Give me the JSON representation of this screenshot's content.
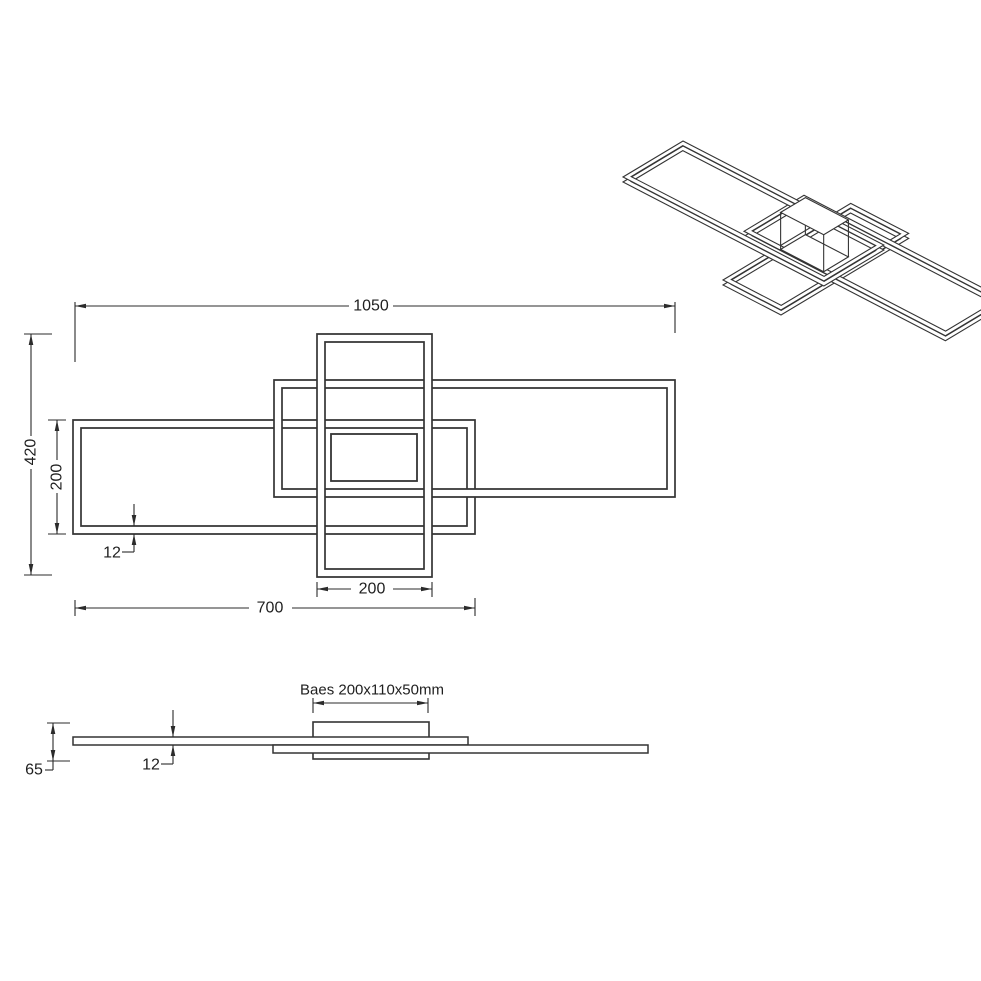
{
  "drawing_title": "ceiling-lamp-technical-drawing",
  "colors": {
    "background": "#ffffff",
    "frame_stroke": "#343434",
    "dim_stroke": "#2b2b2b",
    "text": "#1f1f1f"
  },
  "plan_view": {
    "frames": [
      {
        "name": "left-frame",
        "outer": [
          73,
          420,
          475,
          534
        ],
        "inner": [
          81,
          428,
          467,
          526
        ]
      },
      {
        "name": "right-frame",
        "outer": [
          274,
          380,
          675,
          497
        ],
        "inner": [
          282,
          388,
          667,
          489
        ]
      },
      {
        "name": "cross-frame",
        "outer": [
          317,
          334,
          432,
          577
        ],
        "inner": [
          325,
          342,
          424,
          569
        ]
      }
    ],
    "base_rect": [
      331,
      434,
      417,
      481
    ],
    "dimensions": [
      {
        "name": "dim-width-1050",
        "text": "1050",
        "lines": [
          [
            75,
            306,
            349,
            306
          ],
          [
            393,
            306,
            675,
            306
          ],
          [
            75,
            302,
            75,
            362
          ],
          [
            675,
            302,
            675,
            333
          ]
        ],
        "arrows": [
          [
            75,
            306,
            180
          ],
          [
            675,
            306,
            0
          ]
        ],
        "label": {
          "x": 371,
          "y": 306,
          "rot": 0
        }
      },
      {
        "name": "dim-height-420",
        "text": "420",
        "lines": [
          [
            31,
            334,
            31,
            436
          ],
          [
            31,
            469,
            31,
            575
          ],
          [
            24,
            334,
            52,
            334
          ],
          [
            24,
            575,
            52,
            575
          ]
        ],
        "arrows": [
          [
            31,
            334,
            -90
          ],
          [
            31,
            575,
            90
          ]
        ],
        "label": {
          "x": 31,
          "y": 452,
          "rot": -90
        }
      },
      {
        "name": "dim-height-200",
        "text": "200",
        "lines": [
          [
            57,
            420,
            57,
            460
          ],
          [
            57,
            493,
            57,
            534
          ],
          [
            48,
            420,
            66,
            420
          ],
          [
            48,
            534,
            66,
            534
          ]
        ],
        "arrows": [
          [
            57,
            420,
            -90
          ],
          [
            57,
            534,
            90
          ]
        ],
        "label": {
          "x": 57,
          "y": 477,
          "rot": -90
        }
      },
      {
        "name": "dim-thickness-12",
        "text": "12",
        "lines": [
          [
            134,
            504,
            134,
            526
          ],
          [
            134,
            534,
            134,
            552
          ],
          [
            122,
            552,
            134,
            552
          ]
        ],
        "arrows": [
          [
            134,
            526,
            90
          ],
          [
            134,
            534,
            -90
          ]
        ],
        "label": {
          "x": 112,
          "y": 553,
          "rot": 0
        }
      },
      {
        "name": "dim-width-200",
        "text": "200",
        "lines": [
          [
            317,
            582,
            317,
            597
          ],
          [
            432,
            582,
            432,
            597
          ],
          [
            317,
            589,
            351,
            589
          ],
          [
            393,
            589,
            432,
            589
          ]
        ],
        "arrows": [
          [
            317,
            589,
            180
          ],
          [
            432,
            589,
            0
          ]
        ],
        "label": {
          "x": 372,
          "y": 589,
          "rot": 0
        }
      },
      {
        "name": "dim-width-700",
        "text": "700",
        "lines": [
          [
            75,
            600,
            75,
            616
          ],
          [
            475,
            598,
            475,
            616
          ],
          [
            75,
            608,
            249,
            608
          ],
          [
            292,
            608,
            475,
            608
          ]
        ],
        "arrows": [
          [
            75,
            608,
            180
          ],
          [
            475,
            608,
            0
          ]
        ],
        "label": {
          "x": 270,
          "y": 608,
          "rot": 0
        }
      }
    ]
  },
  "side_view": {
    "base_box": [
      313,
      722,
      429,
      759
    ],
    "top_bar": [
      73,
      737,
      468,
      745
    ],
    "bottom_bar": [
      273,
      745,
      648,
      753
    ],
    "dimensions": [
      {
        "name": "dim-base-size",
        "text": "Baes 200x110x50mm",
        "lines": [
          [
            313,
            698,
            313,
            713
          ],
          [
            428,
            698,
            428,
            713
          ],
          [
            313,
            703,
            428,
            703
          ]
        ],
        "arrows": [
          [
            313,
            703,
            180
          ],
          [
            428,
            703,
            0
          ]
        ],
        "label": {
          "x": 372,
          "y": 690,
          "rot": 0
        }
      },
      {
        "name": "dim-thickness-12-side",
        "text": "12",
        "lines": [
          [
            173,
            710,
            173,
            737
          ],
          [
            173,
            745,
            173,
            764
          ],
          [
            161,
            764,
            173,
            764
          ]
        ],
        "arrows": [
          [
            173,
            737,
            90
          ],
          [
            173,
            745,
            -90
          ]
        ],
        "label": {
          "x": 151,
          "y": 765,
          "rot": 0
        }
      },
      {
        "name": "dim-height-65",
        "text": "65",
        "lines": [
          [
            53,
            723,
            53,
            770
          ],
          [
            47,
            723,
            70,
            723
          ],
          [
            47,
            761,
            70,
            761
          ],
          [
            45,
            770,
            53,
            770
          ]
        ],
        "arrows": [
          [
            53,
            723,
            -90
          ],
          [
            53,
            761,
            90
          ]
        ],
        "label": {
          "x": 34,
          "y": 770,
          "rot": 0
        }
      }
    ]
  },
  "iso_view": {
    "origin": [
      683,
      141
    ],
    "u": [
      0.287,
      0.1486
    ],
    "v": [
      -0.3,
      0.18
    ],
    "tube_mm": 14,
    "thickness_px": 5,
    "frames": [
      {
        "name": "cross-frame-3d",
        "rect": [
          427,
          -150.5,
          629,
          275
        ],
        "z": 26
      },
      {
        "name": "right-frame-3d",
        "rect": [
          352,
          -66.5,
          1054,
          133.5
        ],
        "z": 14
      },
      {
        "name": "left-frame-3d",
        "rect": [
          0,
          0,
          700,
          200
        ],
        "z": 0
      }
    ],
    "base_box": {
      "rect": [
        452,
        24.5,
        602,
        107
      ],
      "z_top": -15,
      "z_bottom": 22
    }
  }
}
